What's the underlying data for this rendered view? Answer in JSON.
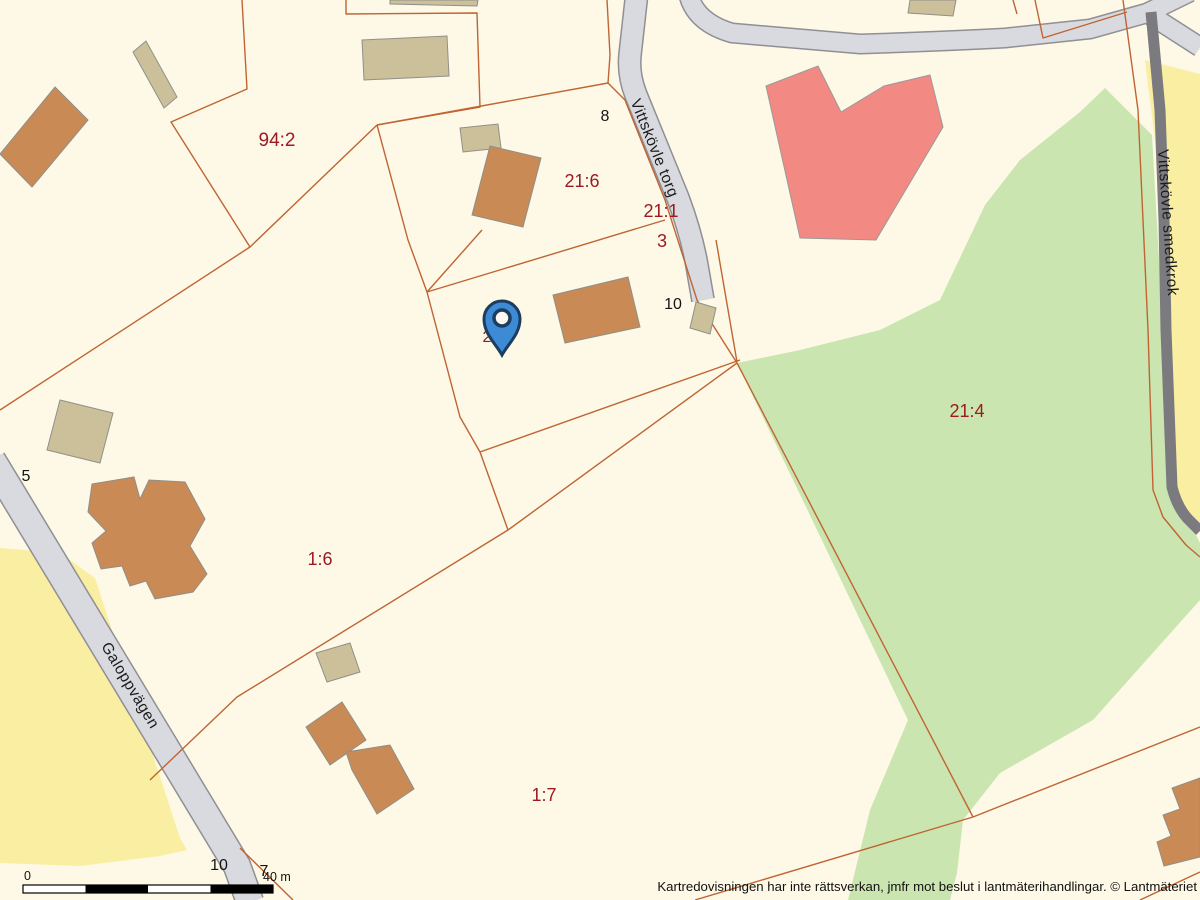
{
  "map": {
    "attribution": "Kartredovisningen har inte rättsverkan, jmfr mot beslut i lantmäterihandlingar. © Lantmäteriet",
    "scale_bar": {
      "zero_label": "0",
      "distance_label": "40 m"
    },
    "roads": [
      {
        "name": "Vittskövle torg"
      },
      {
        "name": "Vittskövle smedkrok"
      },
      {
        "name": "Galoppvägen"
      }
    ],
    "parcel_labels": [
      {
        "text": "94:2"
      },
      {
        "text": "21:6"
      },
      {
        "text": "21:1"
      },
      {
        "text": "3"
      },
      {
        "text": "21:4"
      },
      {
        "text": "1:6"
      },
      {
        "text": "1:7"
      },
      {
        "text": "2"
      }
    ],
    "address_numbers": [
      {
        "text": "8"
      },
      {
        "text": "10"
      },
      {
        "text": "5"
      },
      {
        "text": "10"
      },
      {
        "text": "7"
      }
    ],
    "marker": {
      "icon": "location-pin"
    },
    "colors": {
      "background": "#FDF9E6",
      "field_yellow": "#F9EEA2",
      "vegetation_green": "#CBE5B0",
      "road_fill": "#D9D9E0",
      "road_casing": "#8F8F94",
      "minor_road": "#7B7B7F",
      "parcel_line": "#C06433",
      "building_brown": "#C98A55",
      "building_tan": "#CBC099",
      "building_pink": "#F28983",
      "parcel_label": "#9C1A23",
      "marker_blue": "#3D8BD5"
    }
  }
}
